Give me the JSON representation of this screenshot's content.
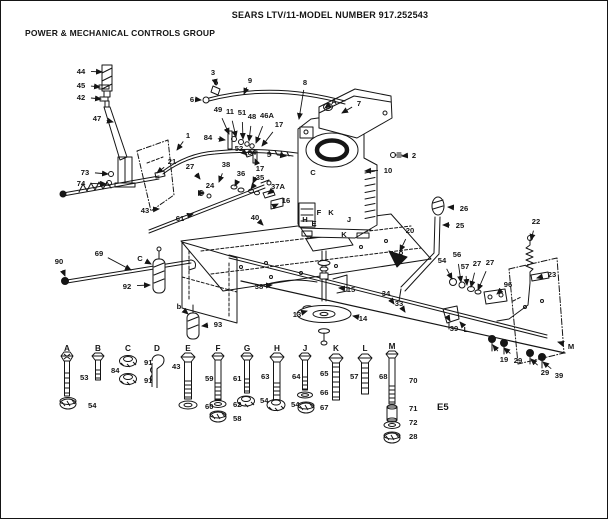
{
  "header": {
    "model_title": "SEARS LTV/11-MODEL NUMBER 917.252543",
    "group_title": "POWER & MECHANICAL CONTROLS GROUP",
    "page_ref": "E5"
  },
  "diagram": {
    "callouts": [
      {
        "label": "44",
        "x": 80,
        "y": 73,
        "tx": 101,
        "ty": 71
      },
      {
        "label": "45",
        "x": 80,
        "y": 87,
        "tx": 99,
        "ty": 86
      },
      {
        "label": "42",
        "x": 80,
        "y": 99,
        "tx": 100,
        "ty": 98
      },
      {
        "label": "47",
        "x": 96,
        "y": 120,
        "tx": 112,
        "ty": 121
      },
      {
        "label": "73",
        "x": 84,
        "y": 174,
        "tx": 107,
        "ty": 173
      },
      {
        "label": "74",
        "x": 80,
        "y": 185,
        "tx": 105,
        "ty": 183
      },
      {
        "label": "21",
        "x": 171,
        "y": 163,
        "tx": 156,
        "ty": 172
      },
      {
        "label": "6",
        "x": 191,
        "y": 101,
        "tx": 200,
        "ty": 99
      },
      {
        "label": "3",
        "x": 212,
        "y": 74,
        "tx": 215,
        "ty": 84
      },
      {
        "label": "9",
        "x": 249,
        "y": 82,
        "tx": 243,
        "ty": 93
      },
      {
        "label": "8",
        "x": 304,
        "y": 84,
        "tx": 298,
        "ty": 118
      },
      {
        "label": "7",
        "x": 358,
        "y": 105,
        "tx": 341,
        "ty": 112
      },
      {
        "label": "A",
        "x": 333,
        "y": 103,
        "tx": 324,
        "ty": 107
      },
      {
        "label": "2",
        "x": 413,
        "y": 157,
        "tx": 401,
        "ty": 155
      },
      {
        "label": "10",
        "x": 387,
        "y": 172,
        "tx": 364,
        "ty": 170
      },
      {
        "label": "1",
        "x": 187,
        "y": 137,
        "tx": 176,
        "ty": 149
      },
      {
        "label": "84",
        "x": 207,
        "y": 139,
        "tx": 224,
        "ty": 139
      },
      {
        "label": "49",
        "x": 217,
        "y": 111,
        "tx": 228,
        "ty": 133
      },
      {
        "label": "11",
        "x": 229,
        "y": 113,
        "tx": 235,
        "ty": 136
      },
      {
        "label": "51",
        "x": 241,
        "y": 114,
        "tx": 242,
        "ty": 138
      },
      {
        "label": "48",
        "x": 251,
        "y": 118,
        "tx": 248,
        "ty": 140
      },
      {
        "label": "46A",
        "x": 266,
        "y": 117,
        "tx": 255,
        "ty": 142
      },
      {
        "label": "17",
        "x": 278,
        "y": 126,
        "tx": 261,
        "ty": 145
      },
      {
        "label": "52",
        "x": 238,
        "y": 150,
        "tx": 246,
        "ty": 154
      },
      {
        "label": "84",
        "x": 251,
        "y": 154,
        "tx": 254,
        "ty": 158
      },
      {
        "label": "5",
        "x": 268,
        "y": 156,
        "tx": 285,
        "ty": 155
      },
      {
        "label": "27",
        "x": 189,
        "y": 168,
        "tx": 199,
        "ty": 178
      },
      {
        "label": "38",
        "x": 225,
        "y": 166,
        "tx": 218,
        "ty": 181
      },
      {
        "label": "36",
        "x": 240,
        "y": 175,
        "tx": 234,
        "ty": 185
      },
      {
        "label": "24",
        "x": 209,
        "y": 187,
        "tx": 203,
        "ty": 192
      },
      {
        "label": "17",
        "x": 259,
        "y": 170,
        "tx": 252,
        "ty": 182
      },
      {
        "label": "35",
        "x": 259,
        "y": 179,
        "tx": 250,
        "ty": 188
      },
      {
        "label": "37A",
        "x": 277,
        "y": 188,
        "tx": 267,
        "ty": 193
      },
      {
        "label": "16",
        "x": 285,
        "y": 202,
        "tx": 277,
        "ty": 203
      },
      {
        "label": "61",
        "x": 179,
        "y": 220,
        "tx": 192,
        "ty": 213
      },
      {
        "label": "43",
        "x": 144,
        "y": 212,
        "tx": 158,
        "ty": 208
      },
      {
        "label": "40",
        "x": 254,
        "y": 219,
        "tx": 262,
        "ty": 224
      },
      {
        "label": "20",
        "x": 409,
        "y": 232,
        "tx": 399,
        "ty": 250
      },
      {
        "label": "26",
        "x": 463,
        "y": 210,
        "tx": 447,
        "ty": 206
      },
      {
        "label": "25",
        "x": 459,
        "y": 227,
        "tx": 442,
        "ty": 224
      },
      {
        "label": "22",
        "x": 535,
        "y": 223,
        "tx": 530,
        "ty": 239
      },
      {
        "label": "23",
        "x": 551,
        "y": 276,
        "tx": 536,
        "ty": 277
      },
      {
        "label": "54",
        "x": 441,
        "y": 262,
        "tx": 451,
        "ty": 278
      },
      {
        "label": "56",
        "x": 456,
        "y": 256,
        "tx": 460,
        "ty": 281
      },
      {
        "label": "57",
        "x": 464,
        "y": 268,
        "tx": 466,
        "ty": 284
      },
      {
        "label": "27",
        "x": 476,
        "y": 265,
        "tx": 470,
        "ty": 286
      },
      {
        "label": "27",
        "x": 489,
        "y": 264,
        "tx": 477,
        "ty": 289
      },
      {
        "label": "96",
        "x": 507,
        "y": 286,
        "tx": 496,
        "ty": 293
      },
      {
        "label": "34",
        "x": 385,
        "y": 295,
        "tx": 393,
        "ty": 303
      },
      {
        "label": "33",
        "x": 398,
        "y": 305,
        "tx": 404,
        "ty": 311
      },
      {
        "label": "39",
        "x": 453,
        "y": 330,
        "tx": 449,
        "ty": 320
      },
      {
        "label": "L",
        "x": 465,
        "y": 331,
        "tx": 459,
        "ty": 321
      },
      {
        "label": "19",
        "x": 503,
        "y": 361,
        "tx": 492,
        "ty": 344
      },
      {
        "label": "29",
        "x": 517,
        "y": 362,
        "tx": 503,
        "ty": 347
      },
      {
        "label": "29",
        "x": 544,
        "y": 374,
        "tx": 530,
        "ty": 358
      },
      {
        "label": "39",
        "x": 558,
        "y": 377,
        "tx": 542,
        "ty": 361
      },
      {
        "label": "M",
        "x": 570,
        "y": 348,
        "tx": 557,
        "ty": 341
      },
      {
        "label": "69",
        "x": 98,
        "y": 255,
        "tx": 130,
        "ty": 269
      },
      {
        "label": "90",
        "x": 58,
        "y": 263,
        "tx": 64,
        "ty": 275
      },
      {
        "label": "92",
        "x": 126,
        "y": 288,
        "tx": 149,
        "ty": 284
      },
      {
        "label": "C",
        "x": 139,
        "y": 260,
        "tx": 150,
        "ty": 263
      },
      {
        "label": "b",
        "x": 178,
        "y": 308,
        "tx": 187,
        "ty": 313
      },
      {
        "label": "93",
        "x": 217,
        "y": 326,
        "tx": 201,
        "ty": 325
      },
      {
        "label": "38",
        "x": 258,
        "y": 288,
        "tx": 271,
        "ty": 284
      },
      {
        "label": "15",
        "x": 350,
        "y": 291,
        "tx": 338,
        "ty": 287
      },
      {
        "label": "13",
        "x": 296,
        "y": 316,
        "tx": 306,
        "ty": 310
      },
      {
        "label": "14",
        "x": 362,
        "y": 320,
        "tx": 352,
        "ty": 315
      },
      {
        "label": "C",
        "x": 312,
        "y": 174
      },
      {
        "label": "F",
        "x": 318,
        "y": 214
      },
      {
        "label": "K",
        "x": 330,
        "y": 214
      },
      {
        "label": "H",
        "x": 304,
        "y": 221
      },
      {
        "label": "E",
        "x": 313,
        "y": 225
      },
      {
        "label": "J",
        "x": 348,
        "y": 221
      },
      {
        "label": "K",
        "x": 343,
        "y": 236
      }
    ]
  },
  "legend": {
    "items": [
      {
        "letter": "A",
        "x": 66,
        "y": 350,
        "glyphs": [
          "hex-bolt-lockwasher",
          "flange-locknut"
        ],
        "parts": [
          {
            "label": "53",
            "x": 79,
            "y": 379
          },
          {
            "label": "54",
            "x": 87,
            "y": 407
          }
        ]
      },
      {
        "letter": "B",
        "x": 97,
        "y": 350,
        "glyphs": [
          "hex-bolt-short"
        ],
        "parts": [
          {
            "label": "84",
            "x": 110,
            "y": 372
          }
        ]
      },
      {
        "letter": "C",
        "x": 127,
        "y": 350,
        "glyphs": [
          "flange-nut",
          "flange-nut"
        ],
        "parts": [
          {
            "label": "91",
            "x": 143,
            "y": 364
          },
          {
            "label": "91",
            "x": 143,
            "y": 382
          }
        ]
      },
      {
        "letter": "D",
        "x": 156,
        "y": 350,
        "glyphs": [
          "cotter-clip"
        ],
        "parts": [
          {
            "label": "43",
            "x": 171,
            "y": 368
          }
        ]
      },
      {
        "letter": "E",
        "x": 187,
        "y": 350,
        "glyphs": [
          "hex-bolt-large",
          "washer"
        ],
        "parts": [
          {
            "label": "59",
            "x": 204,
            "y": 380
          },
          {
            "label": "60",
            "x": 204,
            "y": 408
          }
        ]
      },
      {
        "letter": "F",
        "x": 217,
        "y": 350,
        "glyphs": [
          "hex-bolt-long",
          "washer",
          "flange-locknut"
        ],
        "parts": [
          {
            "label": "61",
            "x": 232,
            "y": 380
          },
          {
            "label": "62",
            "x": 232,
            "y": 406
          },
          {
            "label": "58",
            "x": 232,
            "y": 420
          }
        ]
      },
      {
        "letter": "G",
        "x": 246,
        "y": 350,
        "glyphs": [
          "hex-bolt",
          "flange-nut"
        ],
        "parts": [
          {
            "label": "63",
            "x": 260,
            "y": 378
          },
          {
            "label": "54",
            "x": 259,
            "y": 402
          }
        ]
      },
      {
        "letter": "H",
        "x": 276,
        "y": 350,
        "glyphs": [
          "hex-bolt-large",
          "flange-nut"
        ],
        "parts": [
          {
            "label": "64",
            "x": 291,
            "y": 378
          },
          {
            "label": "54",
            "x": 290,
            "y": 406
          }
        ]
      },
      {
        "letter": "J",
        "x": 304,
        "y": 350,
        "glyphs": [
          "hex-bolt",
          "washer",
          "flange-locknut"
        ],
        "parts": [
          {
            "label": "65",
            "x": 319,
            "y": 375
          },
          {
            "label": "66",
            "x": 319,
            "y": 394
          },
          {
            "label": "67",
            "x": 319,
            "y": 409
          }
        ]
      },
      {
        "letter": "K",
        "x": 335,
        "y": 350,
        "glyphs": [
          "hex-bolt-large"
        ],
        "parts": [
          {
            "label": "57",
            "x": 349,
            "y": 378
          }
        ]
      },
      {
        "letter": "L",
        "x": 364,
        "y": 350,
        "glyphs": [
          "hex-bolt-large"
        ],
        "parts": [
          {
            "label": "68",
            "x": 378,
            "y": 378
          }
        ]
      },
      {
        "letter": "M",
        "x": 391,
        "y": 348,
        "glyphs": [
          "hex-bolt-extra-long",
          "spacer",
          "washer",
          "flange-locknut"
        ],
        "parts": [
          {
            "label": "70",
            "x": 408,
            "y": 382
          },
          {
            "label": "71",
            "x": 408,
            "y": 410
          },
          {
            "label": "72",
            "x": 408,
            "y": 424
          },
          {
            "label": "28",
            "x": 408,
            "y": 438
          }
        ]
      }
    ]
  }
}
